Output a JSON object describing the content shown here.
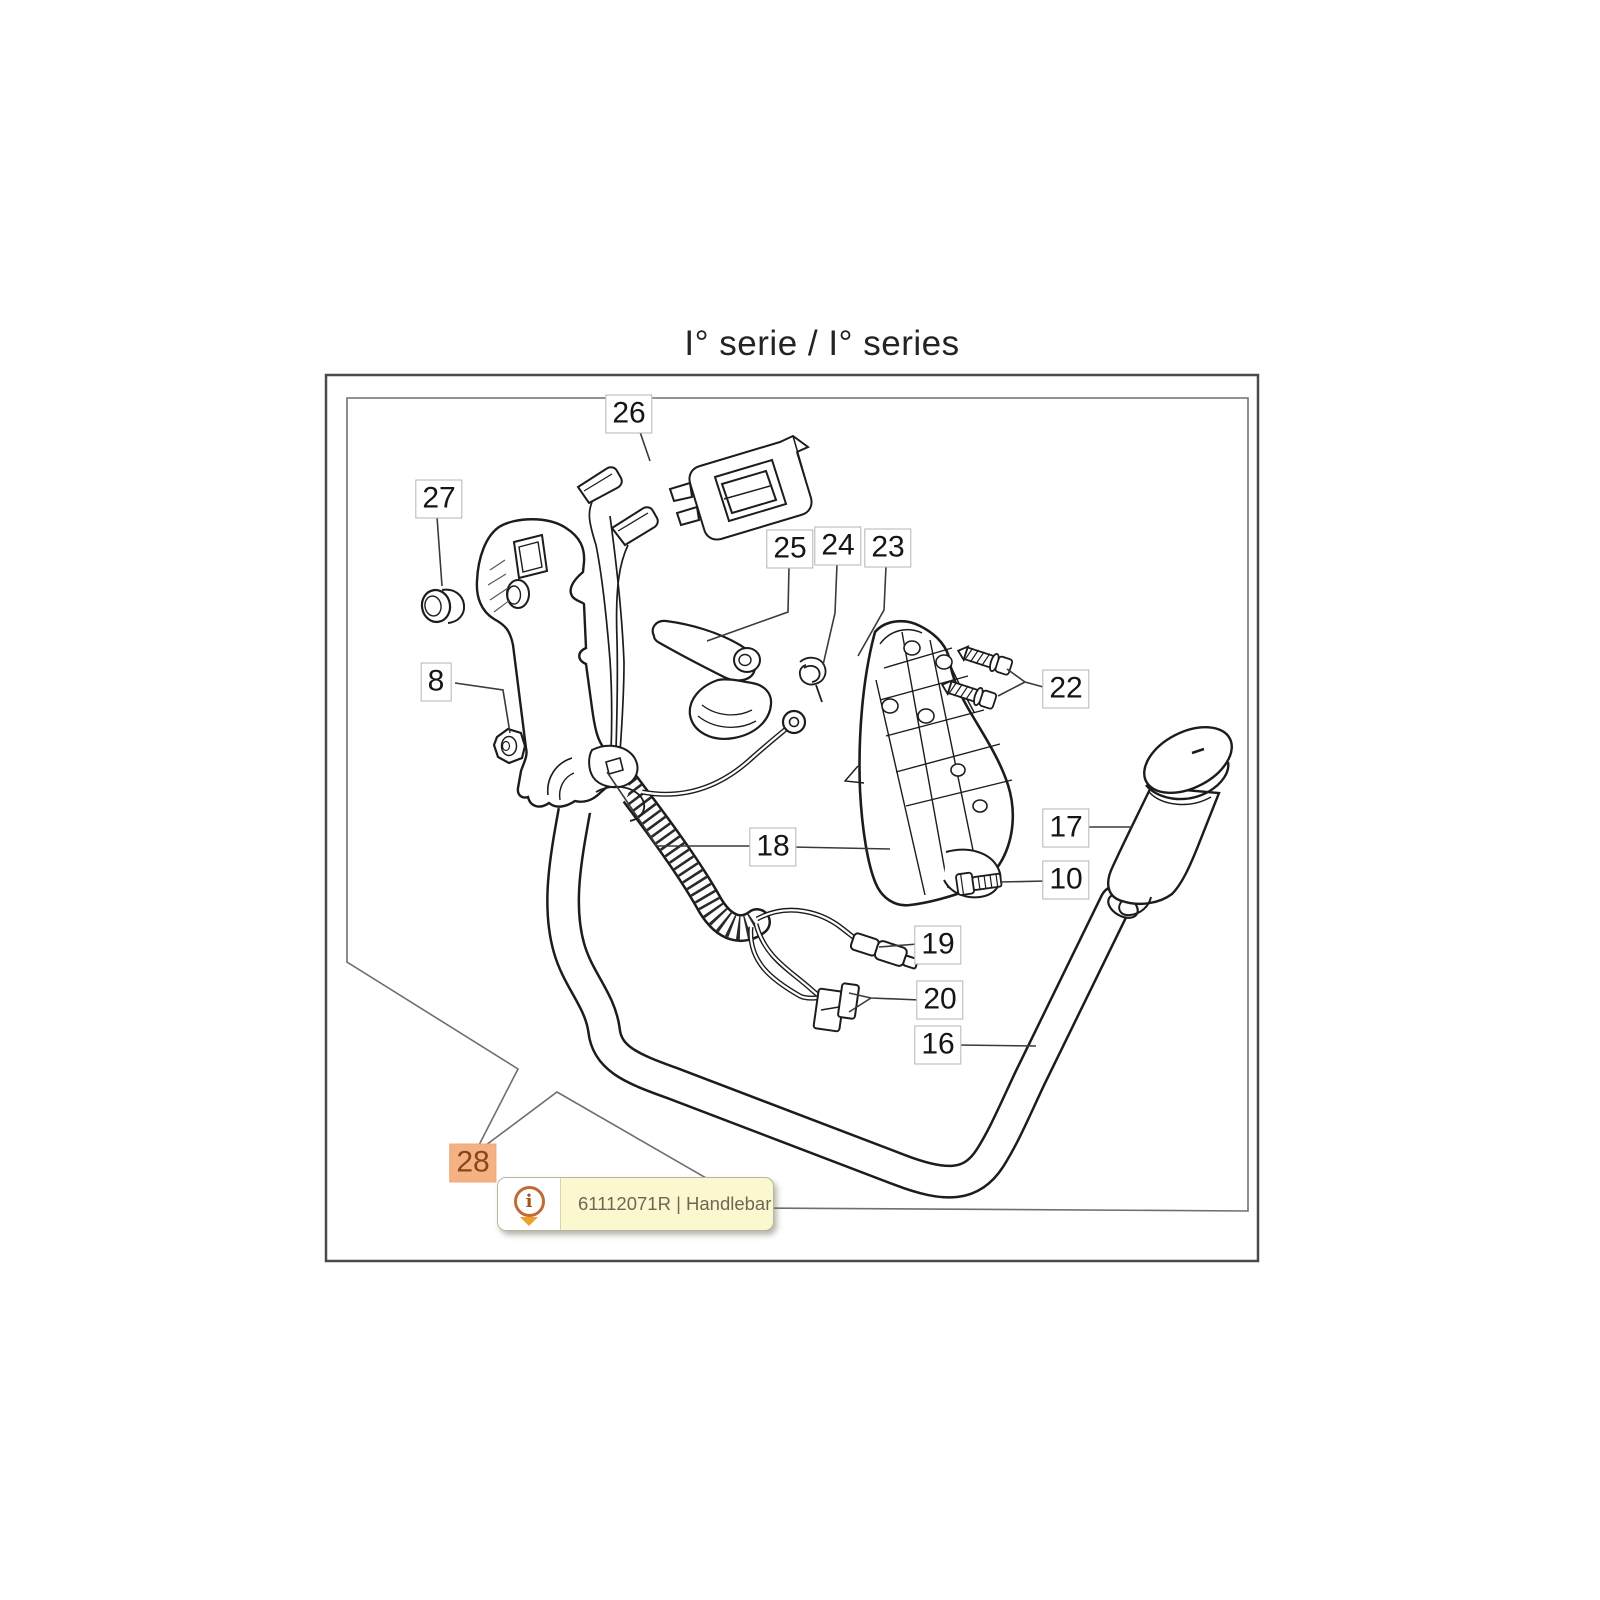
{
  "title": "I° serie / I° series",
  "diagram": {
    "selected_part": "28",
    "part_labels": [
      {
        "id": "26",
        "x": 629,
        "y": 414,
        "selected": false
      },
      {
        "id": "27",
        "x": 439,
        "y": 499,
        "selected": false
      },
      {
        "id": "25",
        "x": 790,
        "y": 549,
        "selected": false
      },
      {
        "id": "24",
        "x": 838,
        "y": 546,
        "selected": false
      },
      {
        "id": "23",
        "x": 888,
        "y": 548,
        "selected": false
      },
      {
        "id": "8",
        "x": 436,
        "y": 682,
        "selected": false
      },
      {
        "id": "22",
        "x": 1066,
        "y": 689,
        "selected": false
      },
      {
        "id": "17",
        "x": 1066,
        "y": 828,
        "selected": false
      },
      {
        "id": "10",
        "x": 1066,
        "y": 880,
        "selected": false
      },
      {
        "id": "18",
        "x": 773,
        "y": 847,
        "selected": false
      },
      {
        "id": "19",
        "x": 938,
        "y": 945,
        "selected": false
      },
      {
        "id": "20",
        "x": 940,
        "y": 1000,
        "selected": false
      },
      {
        "id": "16",
        "x": 938,
        "y": 1045,
        "selected": false
      },
      {
        "id": "28",
        "x": 473,
        "y": 1163,
        "selected": true
      }
    ]
  },
  "tooltip": {
    "part_code": "61112071R",
    "part_name": "Handlebar",
    "text": "61112071R | Handlebar",
    "icon_glyph": "i"
  },
  "colors": {
    "selected_badge_bg": "#F4B183",
    "selected_badge_text": "#8C4515",
    "tooltip_bg": "#FBF8D0",
    "info_ring": "#C06B35",
    "info_arrow": "#EFA22B"
  }
}
